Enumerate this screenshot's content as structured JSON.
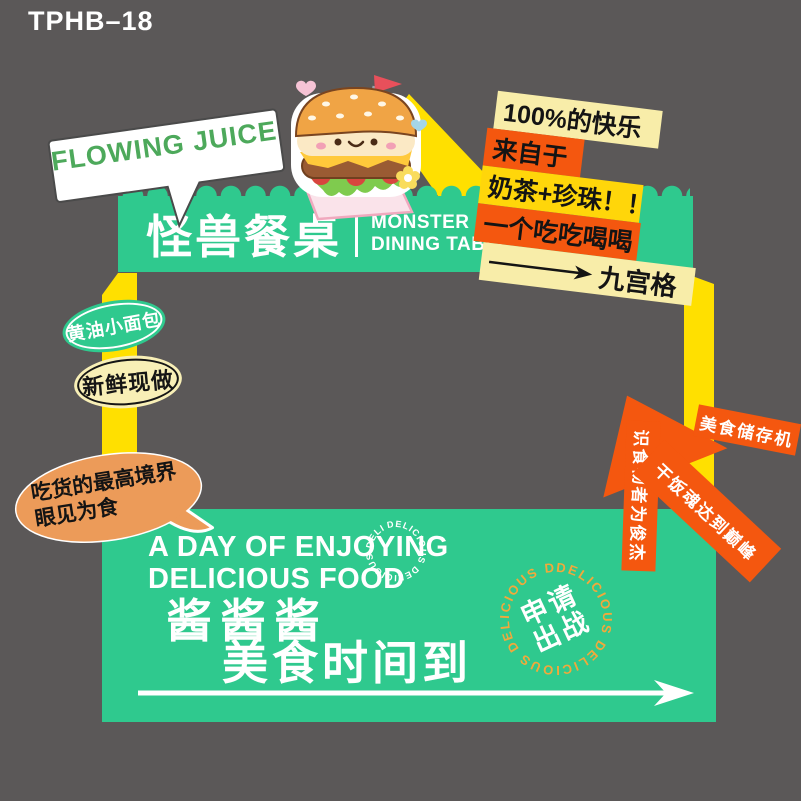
{
  "product_code": "TPHB–18",
  "speech_bubble": {
    "text": "FLOWING JUICE"
  },
  "banner": {
    "title_cn": "怪兽餐桌",
    "title_en_line1": "MONSTER",
    "title_en_line2": "DINING TABLE"
  },
  "sticker": {
    "lines": [
      {
        "text": "100%的快乐"
      },
      {
        "text": "来自于"
      },
      {
        "text": "奶茶+珍珠！！"
      },
      {
        "text": "一个吃吃喝喝"
      }
    ],
    "arrow_label": "九宫格"
  },
  "badges": {
    "green_oval": "黄油小面包",
    "cream_oval": "新鲜现做"
  },
  "orange_bubble": {
    "line1": "吃货的最高境界",
    "line2": "眼见为食"
  },
  "orange_arrow": {
    "top_label": "美食储存机",
    "side_label": "识食物者为俊杰",
    "shaft_label": "干饭魂达到巅峰"
  },
  "bottom_panel": {
    "heading_line1": "A DAY OF ENJOYING",
    "heading_line2": "DELICIOUS FOOD",
    "cn_line1": "酱酱酱",
    "cn_line2": "美食时间到",
    "small_ring_text": "DELICIOUS DELICIOUS DELICIOUS",
    "stamp": {
      "ring_text": "DELICIOUS DELICIOUS DELICIOUS DELICIOUS",
      "cn_line1": "申请",
      "cn_line2": "出战"
    }
  },
  "colors": {
    "background": "#5B5858",
    "green": "#2FC98E",
    "frame_yellow": "#FFE000",
    "orange": "#F4570F",
    "soft_orange": "#EC9B59",
    "cream": "#F8EDA9",
    "strip_yellow": "#FFD60A",
    "stamp_ring": "#F2A93B",
    "juice_text_green": "#4DA95B"
  }
}
